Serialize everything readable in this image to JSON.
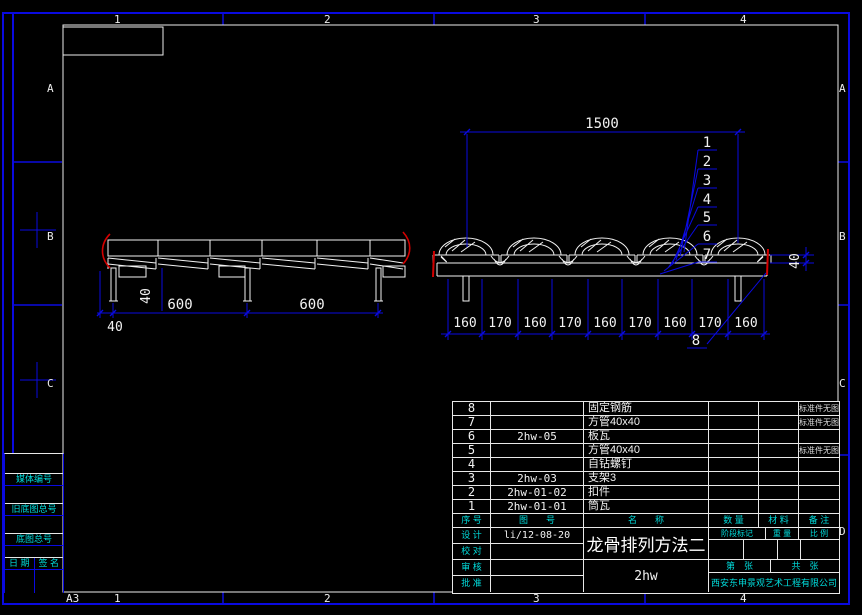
{
  "frame": {
    "sheet_size_label": "A3",
    "top_zone_numbers": [
      "1",
      "2",
      "3",
      "4"
    ],
    "bottom_zone_numbers": [
      "1",
      "2",
      "3",
      "4"
    ],
    "left_zone_letters": [
      "A",
      "B",
      "C"
    ],
    "right_zone_letters": [
      "A",
      "B",
      "C",
      "D"
    ]
  },
  "margin_boxes": {
    "media_no_label": "媒体编号",
    "old_base_no_label": "旧底图总号",
    "base_no_label": "底图总号",
    "date_label": "日 期",
    "sign_label": "签 名"
  },
  "drawing": {
    "callouts": [
      "1",
      "2",
      "3",
      "4",
      "5",
      "6",
      "7",
      "8"
    ],
    "elevation_dims": {
      "left_offset": "40",
      "hanger_height": "40",
      "spacing_1": "600",
      "spacing_2": "600"
    },
    "section_dims": {
      "overall": "1500",
      "height": "40",
      "pitch": [
        "160",
        "170",
        "160",
        "170",
        "160",
        "170",
        "160",
        "170",
        "160"
      ]
    }
  },
  "title_block": {
    "header": {
      "seq": "序  号",
      "dwg": "图　　号",
      "name": "名　　称",
      "qty": "数  量",
      "material": "材  料",
      "remark": "备  注"
    },
    "parts": [
      {
        "seq": "8",
        "dwg": "",
        "name": "固定钢筋",
        "qty": "",
        "mat": "",
        "remark": "标准件无图"
      },
      {
        "seq": "7",
        "dwg": "",
        "name": "方管40x40",
        "qty": "",
        "mat": "",
        "remark": "标准件无图"
      },
      {
        "seq": "6",
        "dwg": "2hw-05",
        "name": "板瓦",
        "qty": "",
        "mat": "",
        "remark": ""
      },
      {
        "seq": "5",
        "dwg": "",
        "name": "方管40x40",
        "qty": "",
        "mat": "",
        "remark": "标准件无图"
      },
      {
        "seq": "4",
        "dwg": "",
        "name": "自钻螺钉",
        "qty": "",
        "mat": "",
        "remark": ""
      },
      {
        "seq": "3",
        "dwg": "2hw-03",
        "name": "支架3",
        "qty": "",
        "mat": "",
        "remark": ""
      },
      {
        "seq": "2",
        "dwg": "2hw-01-02",
        "name": "扣件",
        "qty": "",
        "mat": "",
        "remark": ""
      },
      {
        "seq": "1",
        "dwg": "2hw-01-01",
        "name": "筒瓦",
        "qty": "",
        "mat": "",
        "remark": ""
      }
    ],
    "sign_rows": [
      {
        "label": "设  计",
        "value": "li/12-08-20"
      },
      {
        "label": "校  对",
        "value": ""
      },
      {
        "label": "审  核",
        "value": ""
      },
      {
        "label": "批  准",
        "value": ""
      }
    ],
    "drawing_title": "龙骨排列方法二",
    "drawing_code": "2hw",
    "stage_label": "阶段标记",
    "weight_label": "重 量",
    "scale_label": "比 例",
    "sheet_no_label": "第　张",
    "sheet_total_label": "共　张",
    "company": "西安东申景观艺术工程有限公司"
  }
}
